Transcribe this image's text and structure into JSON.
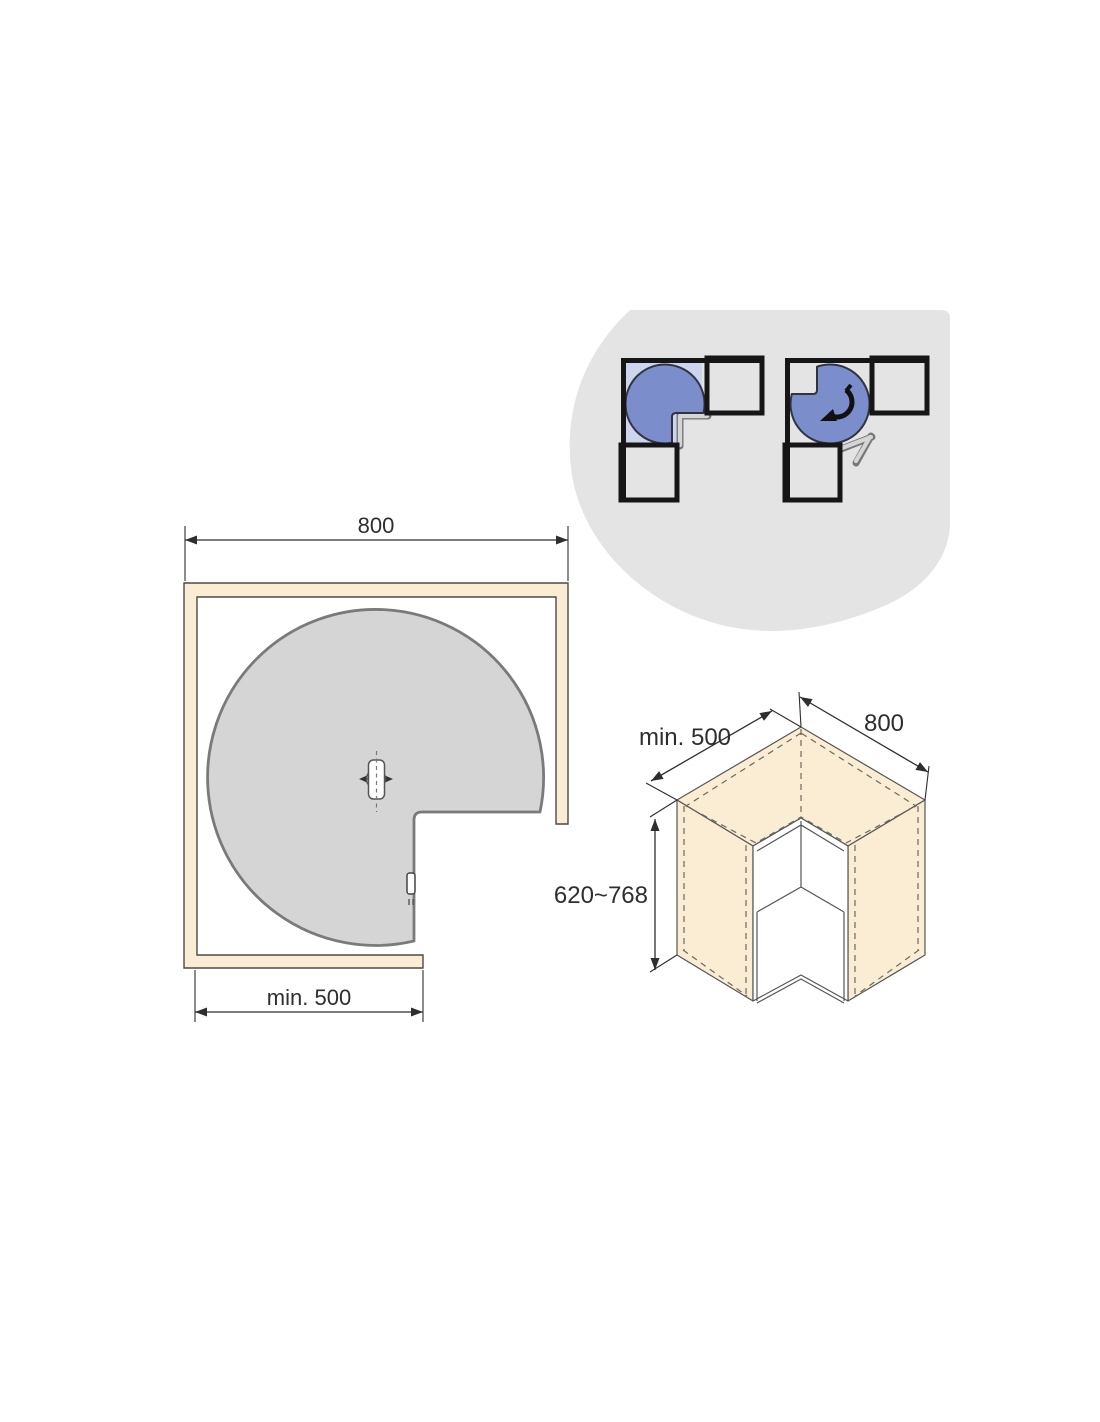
{
  "colors": {
    "page_background": "#ffffff",
    "inset_background": "#e4e4e5",
    "mini_cabinet_outline": "#161616",
    "tray_fill": "#7b8ecb",
    "tray_outline": "#2f3440",
    "tray_zone_fill": "#cdd4ed",
    "door_fill": "#cbcbcb",
    "wall_fill": "#faedd3",
    "wall_outline": "#4a4a4a",
    "carousel_fill": "#d5d5d5",
    "carousel_outline": "#7a7a7a",
    "dimension_color": "#2e2e2e"
  },
  "plan_view": {
    "width_dimension": "800",
    "front_dimension": "min. 500"
  },
  "iso_view": {
    "left_dimension": "min. 500",
    "right_dimension": "800",
    "height_dimension": "620~768"
  }
}
